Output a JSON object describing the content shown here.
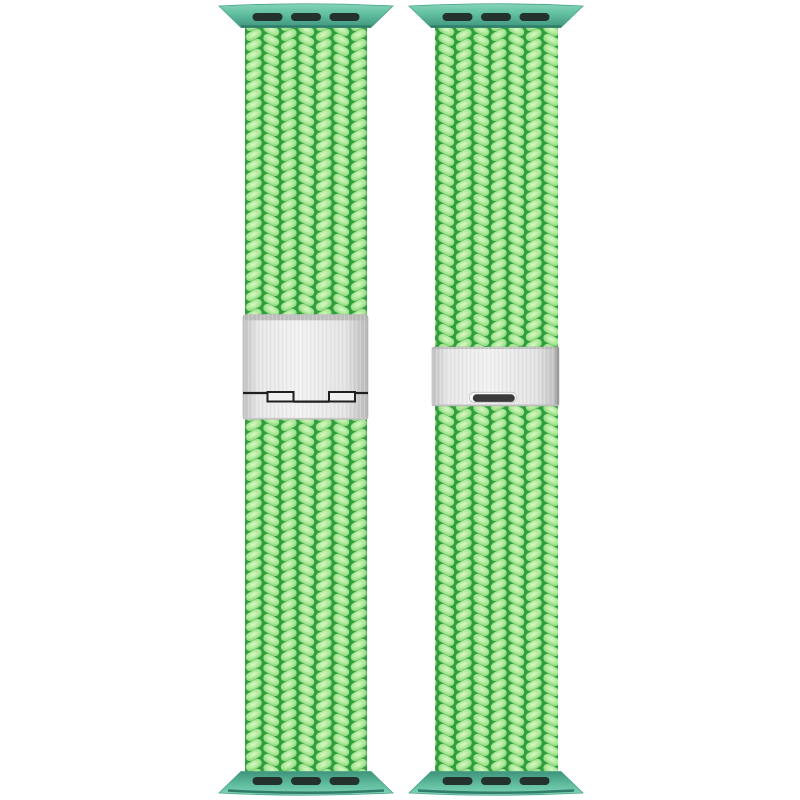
{
  "scene": {
    "description": "Two bright mint-green braided watch straps shown vertically side by side on a white background",
    "left_band": {
      "label": "braided strap with fold-over clasp"
    },
    "right_band": {
      "label": "braided strap with slide buckle"
    },
    "adapter_slots_per_connector": 3
  },
  "colors": {
    "background": "#ffffff",
    "braid_highlight": "#d8f9c6",
    "braid_light": "#abe797",
    "braid_mid": "#7bce6b",
    "braid_dark": "#2f9e3e",
    "connector_light": "#85d4b8",
    "connector_teal": "#63c1a2",
    "connector_dark": "#3f947c",
    "connector_rim": "#2f7c68",
    "adapter_slot": "#24322d",
    "clasp_face": "#f1f1f1",
    "clasp_edge": "#bfbfbf",
    "clasp_top_strip": "#b6b6b6",
    "hinge_line": "#1f1f1f",
    "slot_dark": "#3a3a3a"
  }
}
